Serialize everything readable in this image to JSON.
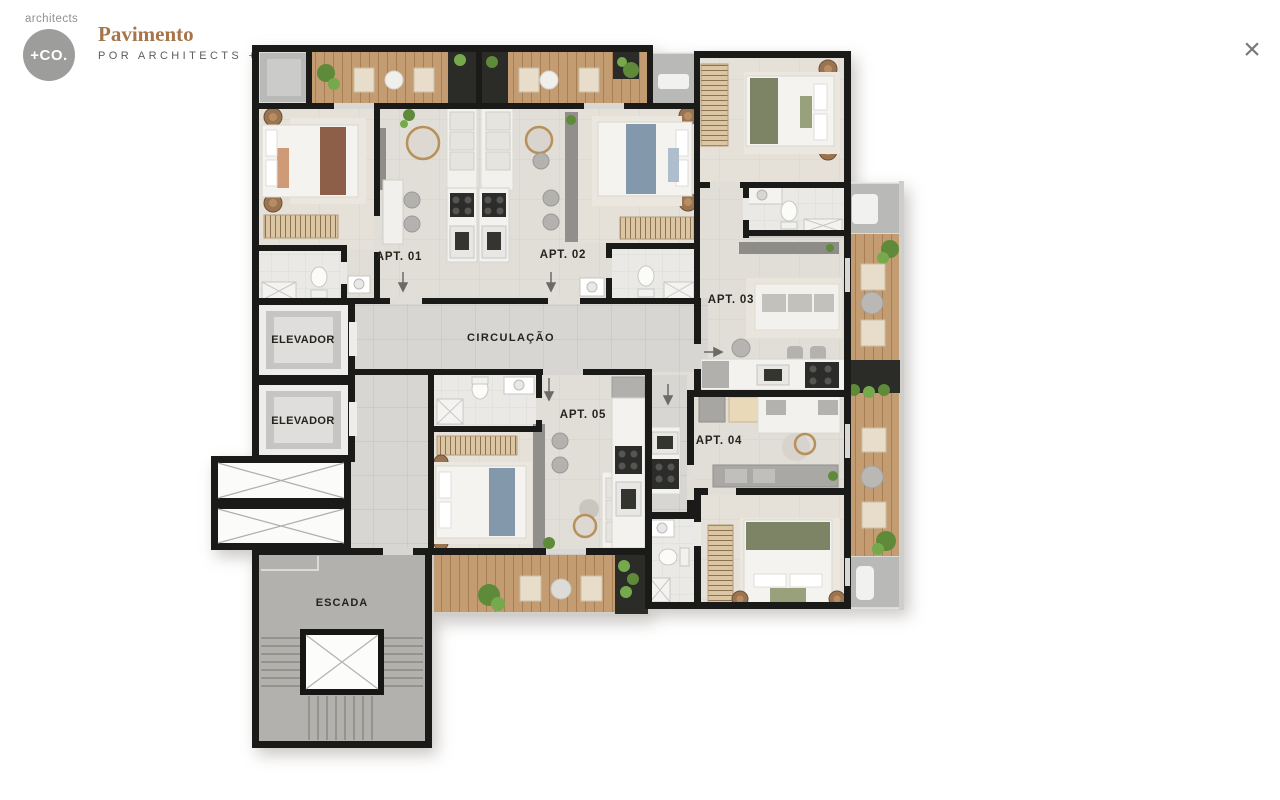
{
  "header": {
    "logo_word": "architects",
    "logo_circle": "+CO.",
    "title": "Pavimento",
    "subtitle": "POR ARCHITECTS +CO"
  },
  "close": {
    "glyph": "×"
  },
  "floor_plan": {
    "units": [
      {
        "id": "apt-01",
        "label": "APT. 01"
      },
      {
        "id": "apt-02",
        "label": "APT. 02"
      },
      {
        "id": "apt-03",
        "label": "APT. 03"
      },
      {
        "id": "apt-04",
        "label": "APT. 04"
      },
      {
        "id": "apt-05",
        "label": "APT. 05"
      }
    ],
    "common_areas": [
      {
        "id": "elevator-1",
        "label": "ELEVADOR"
      },
      {
        "id": "elevator-2",
        "label": "ELEVADOR"
      },
      {
        "id": "circulation",
        "label": "CIRCULAÇÃO"
      },
      {
        "id": "stairs",
        "label": "ESCADA"
      }
    ],
    "colors": {
      "wall": "#1a1a18",
      "floor_living": "#e1ded7",
      "floor_bedroom": "#e6e1d8",
      "floor_tile_corridor": "#d7d6d3",
      "floor_concrete": "#b2b1ad",
      "wood_deck": "#c49c72",
      "title_accent": "#a5764b"
    }
  }
}
